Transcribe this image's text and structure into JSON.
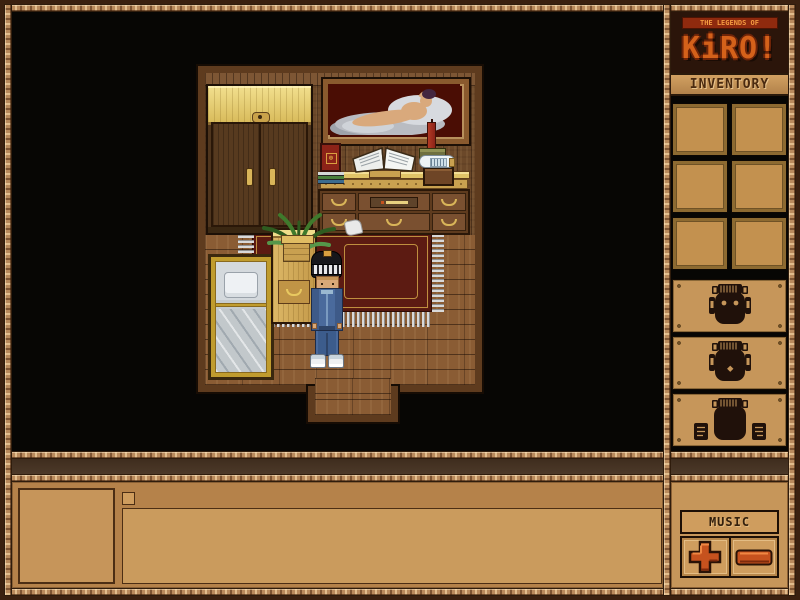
{
  "app": {
    "name": "The Legends of Kiro"
  },
  "logo": {
    "tagline": "THE LEGENDS OF",
    "title": "KiRO!"
  },
  "sidebar": {
    "inventory": {
      "label": "INVENTORY",
      "slot_count": 6,
      "slots": [
        "empty",
        "empty",
        "empty",
        "empty",
        "empty",
        "empty"
      ]
    },
    "emotes": [
      {
        "name": "kiro-face-eyes-open",
        "label": "kiro face eyes open"
      },
      {
        "name": "kiro-face-eyes-closed",
        "label": "kiro face eyes closed with mouth dot"
      },
      {
        "name": "kiro-face-with-fists",
        "label": "kiro face with raised fists"
      }
    ],
    "music": {
      "label": "MUSIC",
      "volume_up": "plus",
      "volume_down": "minus"
    }
  },
  "scene": {
    "room_objects": [
      "wardrobe",
      "painting-reclining-figure",
      "desk-with-drawers",
      "red-book",
      "book-stack",
      "open-book",
      "candle",
      "bottle",
      "small-chest",
      "potted-fern",
      "nightstand",
      "bed-with-pillow",
      "red-rug",
      "paper-scrap"
    ],
    "player": {
      "name": "player-character",
      "outfit": "striped helmet, blue tracksuit, white sneakers"
    }
  },
  "message_panel": {
    "portrait": "",
    "text": ""
  },
  "colors": {
    "frame_dark": "#3b2110",
    "rope_tan": "#b98a5c",
    "panel_tan": "#c6965a",
    "slot_fill": "#c3914f",
    "logo_orange": "#d4611a",
    "legend_bar_red": "#8f2a0e",
    "button_orange": "#c6521e",
    "rug_red": "#5c1b12",
    "wall_brown": "#6b4829",
    "floor_brown": "#8a5c34",
    "game_background": "#070604"
  }
}
